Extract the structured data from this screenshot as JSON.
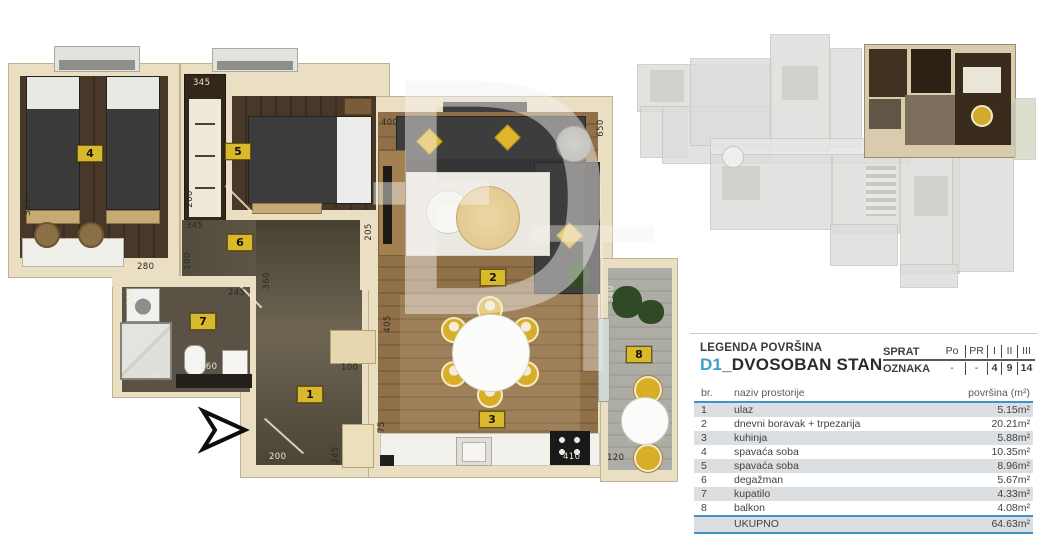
{
  "legend": {
    "title": "LEGENDA POVRŠINA",
    "unit_code": "D1",
    "unit_name": "_DVOSOBAN STAN",
    "floor_table": {
      "row1_label": "SPRAT",
      "row2_label": "OZNAKA",
      "columns": [
        "Po",
        "PR",
        "I",
        "II",
        "III"
      ],
      "marks": [
        "-",
        "-",
        "4",
        "9",
        "14"
      ]
    },
    "area_table": {
      "col_br": "br.",
      "col_name": "naziv prostorije",
      "col_area": "površina (m²)",
      "rows": [
        {
          "br": "1",
          "name": "ulaz",
          "area": "5.15m²"
        },
        {
          "br": "2",
          "name": "dnevni boravak + trpezarija",
          "area": "20.21m²"
        },
        {
          "br": "3",
          "name": "kuhinja",
          "area": "5.88m²"
        },
        {
          "br": "4",
          "name": "spavaća soba",
          "area": "10.35m²"
        },
        {
          "br": "5",
          "name": "spavaća soba",
          "area": "8.96m²"
        },
        {
          "br": "6",
          "name": "degažman",
          "area": "5.67m²"
        },
        {
          "br": "7",
          "name": "kupatilo",
          "area": "4.33m²"
        },
        {
          "br": "8",
          "name": "balkon",
          "area": "4.08m²"
        }
      ],
      "total_label": "UKUPNO",
      "total_area": "64.63m²"
    }
  },
  "floorplan": {
    "watermark": "Đ",
    "watermark2": "T",
    "badges": [
      {
        "number": "1"
      },
      {
        "number": "2"
      },
      {
        "number": "3"
      },
      {
        "number": "4"
      },
      {
        "number": "5"
      },
      {
        "number": "6"
      },
      {
        "number": "7"
      },
      {
        "number": "8"
      }
    ],
    "dimensions": [
      {
        "text": "345"
      },
      {
        "text": "370"
      },
      {
        "text": "260"
      },
      {
        "text": "345"
      },
      {
        "text": "100"
      },
      {
        "text": "280"
      },
      {
        "text": "245"
      },
      {
        "text": "360"
      },
      {
        "text": "205"
      },
      {
        "text": "400"
      },
      {
        "text": "650"
      },
      {
        "text": "190"
      },
      {
        "text": "85"
      },
      {
        "text": "160"
      },
      {
        "text": "100"
      },
      {
        "text": "245"
      },
      {
        "text": "200"
      },
      {
        "text": "405"
      },
      {
        "text": "75"
      },
      {
        "text": "410"
      },
      {
        "text": "120"
      },
      {
        "text": "340"
      }
    ]
  },
  "colors": {
    "accent_blue": "#3f9ecf",
    "table_line_blue": "#4093c6",
    "badge_yellow": "#d9b92c",
    "shaded_row": "#dcdfe1"
  }
}
